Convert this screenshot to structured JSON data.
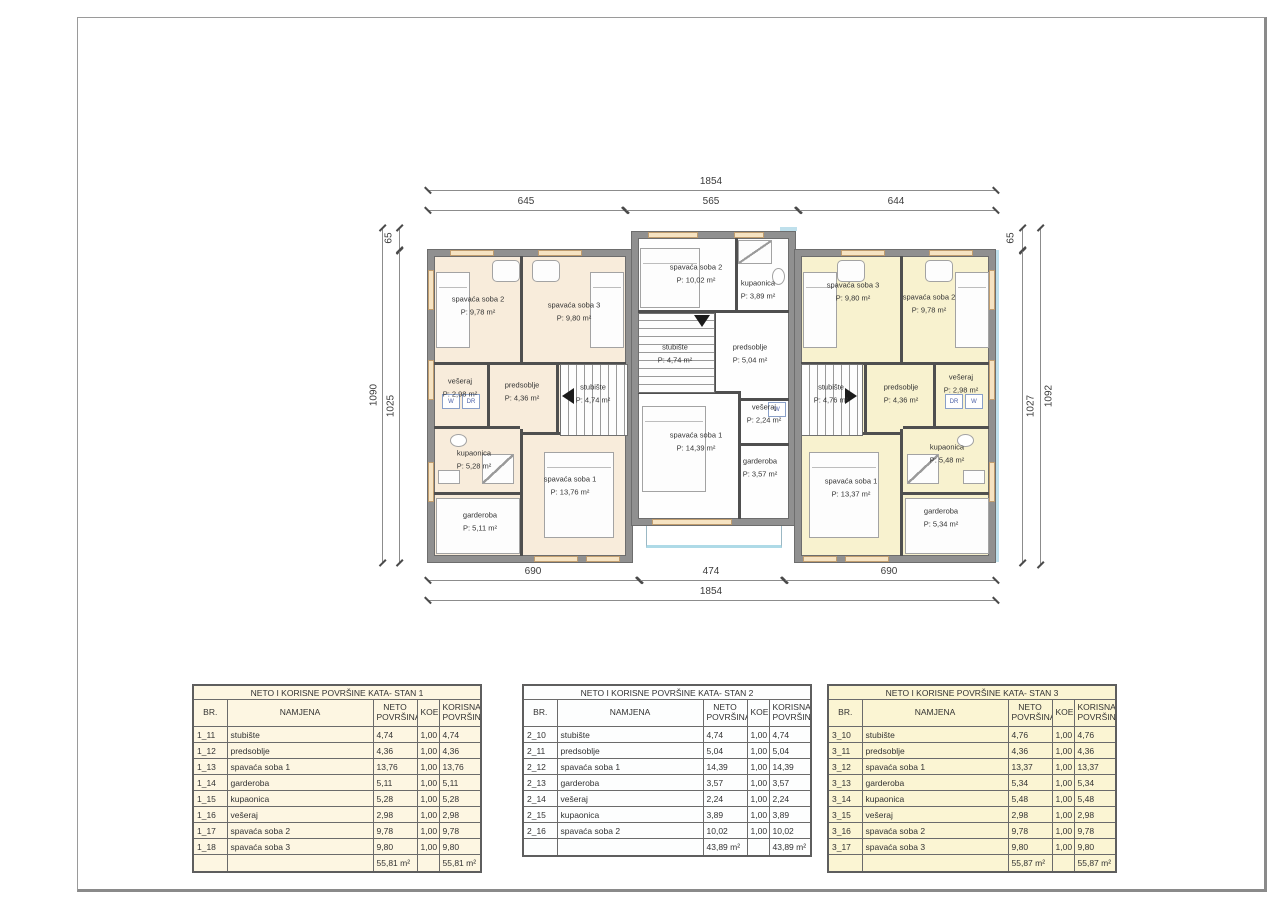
{
  "dims": {
    "top_total": "1854",
    "top_segments": [
      "645",
      "565",
      "644"
    ],
    "bottom_segments": [
      "690",
      "474",
      "690"
    ],
    "bottom_total": "1854",
    "left": [
      "65",
      "1090",
      "1025"
    ],
    "right": [
      "65",
      "1027",
      "1092"
    ]
  },
  "plan": {
    "units": [
      {
        "id": "stan-1",
        "rooms": [
          {
            "name": "spavaća soba 2",
            "area": "P: 9,78 m²"
          },
          {
            "name": "spavaća soba 3",
            "area": "P: 9,80 m²"
          },
          {
            "name": "vešeraj",
            "area": "P: 2,98 m²"
          },
          {
            "name": "predsoblje",
            "area": "P: 4,36 m²"
          },
          {
            "name": "stubište",
            "area": "P: 4,74 m²"
          },
          {
            "name": "kupaonica",
            "area": "P: 5,28 m²"
          },
          {
            "name": "garderoba",
            "area": "P: 5,11 m²"
          },
          {
            "name": "spavaća soba 1",
            "area": "P: 13,76 m²"
          }
        ],
        "appliances": [
          "W",
          "DR"
        ]
      },
      {
        "id": "stan-2",
        "rooms": [
          {
            "name": "spavaća soba 2",
            "area": "P: 10,02 m²"
          },
          {
            "name": "kupaonica",
            "area": "P: 3,89 m²"
          },
          {
            "name": "stubište",
            "area": "P: 4,74 m²"
          },
          {
            "name": "predsoblje",
            "area": "P: 5,04 m²"
          },
          {
            "name": "vešeraj",
            "area": "P: 2,24 m²"
          },
          {
            "name": "spavaća soba 1",
            "area": "P: 14,39 m²"
          },
          {
            "name": "garderoba",
            "area": "P: 3,57 m²"
          }
        ],
        "appliances": [
          "W"
        ]
      },
      {
        "id": "stan-3",
        "rooms": [
          {
            "name": "spavaća soba 3",
            "area": "P: 9,80 m²"
          },
          {
            "name": "spavaća soba 2",
            "area": "P: 9,78 m²"
          },
          {
            "name": "stubište",
            "area": "P: 4,76 m²"
          },
          {
            "name": "predsoblje",
            "area": "P: 4,36 m²"
          },
          {
            "name": "vešeraj",
            "area": "P: 2,98 m²"
          },
          {
            "name": "kupaonica",
            "area": "P: 5,48 m²"
          },
          {
            "name": "garderoba",
            "area": "P: 5,34 m²"
          },
          {
            "name": "spavaća soba 1",
            "area": "P: 13,37 m²"
          }
        ],
        "appliances": [
          "DR",
          "W"
        ]
      }
    ]
  },
  "tables": [
    {
      "title": "NETO I KORISNE POVRŠINE KATA- STAN 1",
      "bg": "#fdf6e2",
      "headers": [
        "BR.",
        "NAMJENA",
        "NETO POVRŠINA",
        "KOEF.",
        "KORISNA POVRŠINA"
      ],
      "rows": [
        [
          "1_11",
          "stubište",
          "4,74",
          "1,00",
          "4,74"
        ],
        [
          "1_12",
          "predsoblje",
          "4,36",
          "1,00",
          "4,36"
        ],
        [
          "1_13",
          "spavaća soba 1",
          "13,76",
          "1,00",
          "13,76"
        ],
        [
          "1_14",
          "garderoba",
          "5,11",
          "1,00",
          "5,11"
        ],
        [
          "1_15",
          "kupaonica",
          "5,28",
          "1,00",
          "5,28"
        ],
        [
          "1_16",
          "vešeraj",
          "2,98",
          "1,00",
          "2,98"
        ],
        [
          "1_17",
          "spavaća soba 2",
          "9,78",
          "1,00",
          "9,78"
        ],
        [
          "1_18",
          "spavaća soba 3",
          "9,80",
          "1,00",
          "9,80"
        ]
      ],
      "total": [
        "",
        "",
        "55,81 m²",
        "",
        "55,81 m²"
      ]
    },
    {
      "title": "NETO I KORISNE POVRŠINE KATA- STAN 2",
      "bg": "#fdfefe",
      "headers": [
        "BR.",
        "NAMJENA",
        "NETO POVRŠINA",
        "KOEF.",
        "KORISNA POVRŠINA"
      ],
      "rows": [
        [
          "2_10",
          "stubište",
          "4,74",
          "1,00",
          "4,74"
        ],
        [
          "2_11",
          "predsoblje",
          "5,04",
          "1,00",
          "5,04"
        ],
        [
          "2_12",
          "spavaća soba 1",
          "14,39",
          "1,00",
          "14,39"
        ],
        [
          "2_13",
          "garderoba",
          "3,57",
          "1,00",
          "3,57"
        ],
        [
          "2_14",
          "vešeraj",
          "2,24",
          "1,00",
          "2,24"
        ],
        [
          "2_15",
          "kupaonica",
          "3,89",
          "1,00",
          "3,89"
        ],
        [
          "2_16",
          "spavaća soba 2",
          "10,02",
          "1,00",
          "10,02"
        ]
      ],
      "total": [
        "",
        "",
        "43,89 m²",
        "",
        "43,89 m²"
      ]
    },
    {
      "title": "NETO I KORISNE POVRŠINE KATA- STAN 3",
      "bg": "#fbf5d3",
      "headers": [
        "BR.",
        "NAMJENA",
        "NETO POVRŠINA",
        "KOEF.",
        "KORISNA POVRŠINA"
      ],
      "rows": [
        [
          "3_10",
          "stubište",
          "4,76",
          "1,00",
          "4,76"
        ],
        [
          "3_11",
          "predsoblje",
          "4,36",
          "1,00",
          "4,36"
        ],
        [
          "3_12",
          "spavaća soba 1",
          "13,37",
          "1,00",
          "13,37"
        ],
        [
          "3_13",
          "garderoba",
          "5,34",
          "1,00",
          "5,34"
        ],
        [
          "3_14",
          "kupaonica",
          "5,48",
          "1,00",
          "5,48"
        ],
        [
          "3_15",
          "vešeraj",
          "2,98",
          "1,00",
          "2,98"
        ],
        [
          "3_16",
          "spavaća soba 2",
          "9,78",
          "1,00",
          "9,78"
        ],
        [
          "3_17",
          "spavaća soba 3",
          "9,80",
          "1,00",
          "9,80"
        ]
      ],
      "total": [
        "",
        "",
        "55,87 m²",
        "",
        "55,87 m²"
      ]
    }
  ],
  "colors": {
    "unit1_floor": "#f8ecdb",
    "unit2_floor": "#fefefe",
    "unit3_floor": "#f8f2cf",
    "wall": "#909090",
    "facade_blue": "#bfe0ec",
    "window_tan": "#f6e3c2"
  }
}
